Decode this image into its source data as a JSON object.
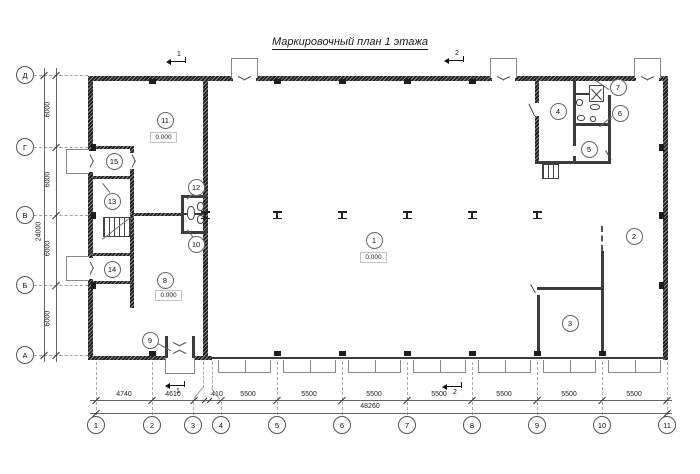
{
  "title": "Маркировочный план 1 этажа",
  "grid": {
    "rows": [
      "Д",
      "Г",
      "В",
      "Б",
      "А"
    ],
    "cols": [
      "1",
      "2",
      "3",
      "4",
      "5",
      "6",
      "7",
      "8",
      "9",
      "10",
      "11"
    ]
  },
  "dimensions": {
    "bottom_segments": [
      "4740",
      "4610",
      "410",
      "5500",
      "5500",
      "5500",
      "5500",
      "5500",
      "5500",
      "5500"
    ],
    "bottom_total": "48260",
    "left_segments": [
      "6000",
      "6000",
      "6000",
      "6000"
    ],
    "left_total": "24000"
  },
  "rooms": [
    "1",
    "2",
    "3",
    "4",
    "5",
    "6",
    "7",
    "8",
    "9",
    "10",
    "11",
    "12",
    "13",
    "14",
    "15"
  ],
  "elevation_marks": [
    "0.000",
    "0.000",
    "0.000"
  ],
  "section_marks": [
    "1",
    "2"
  ]
}
